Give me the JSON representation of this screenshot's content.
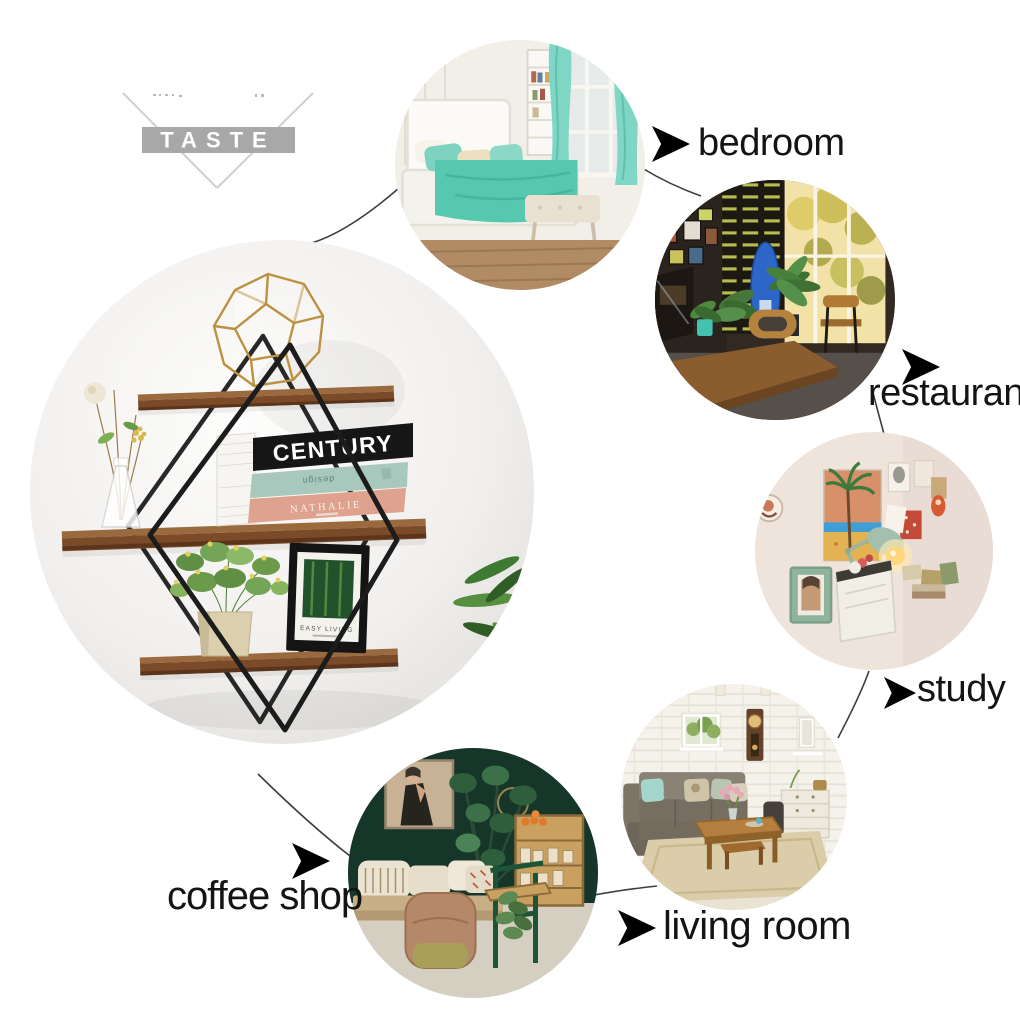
{
  "brand": {
    "logo_text": "TASTE"
  },
  "scene_labels": {
    "bedroom": "bedroom",
    "restaurant": "restaurant",
    "study": "study",
    "living_room": "living room",
    "coffee_shop": "coffee shop"
  },
  "product_photo": {
    "book_top_title": "CENTURY",
    "book_middle_spine_text": "design",
    "book_bottom_title": "NATHALIE",
    "frame_caption": "EASY LIVING"
  },
  "style": {
    "label_color": "#141414",
    "connector_color": "#3d3d3d",
    "arrow_color": "#000000",
    "watermark_gray": "#a8a8a8",
    "wood_brown": "#7b4a28",
    "wire_black": "#1c1c1c",
    "terrarium_gold": "#bd9140",
    "book_black": "#161616",
    "book_teal": "#a8c8bd",
    "book_pink": "#dfa28f",
    "bedroom_teal": "#7fd6c5",
    "coffee_wall_green": "#17362a"
  }
}
